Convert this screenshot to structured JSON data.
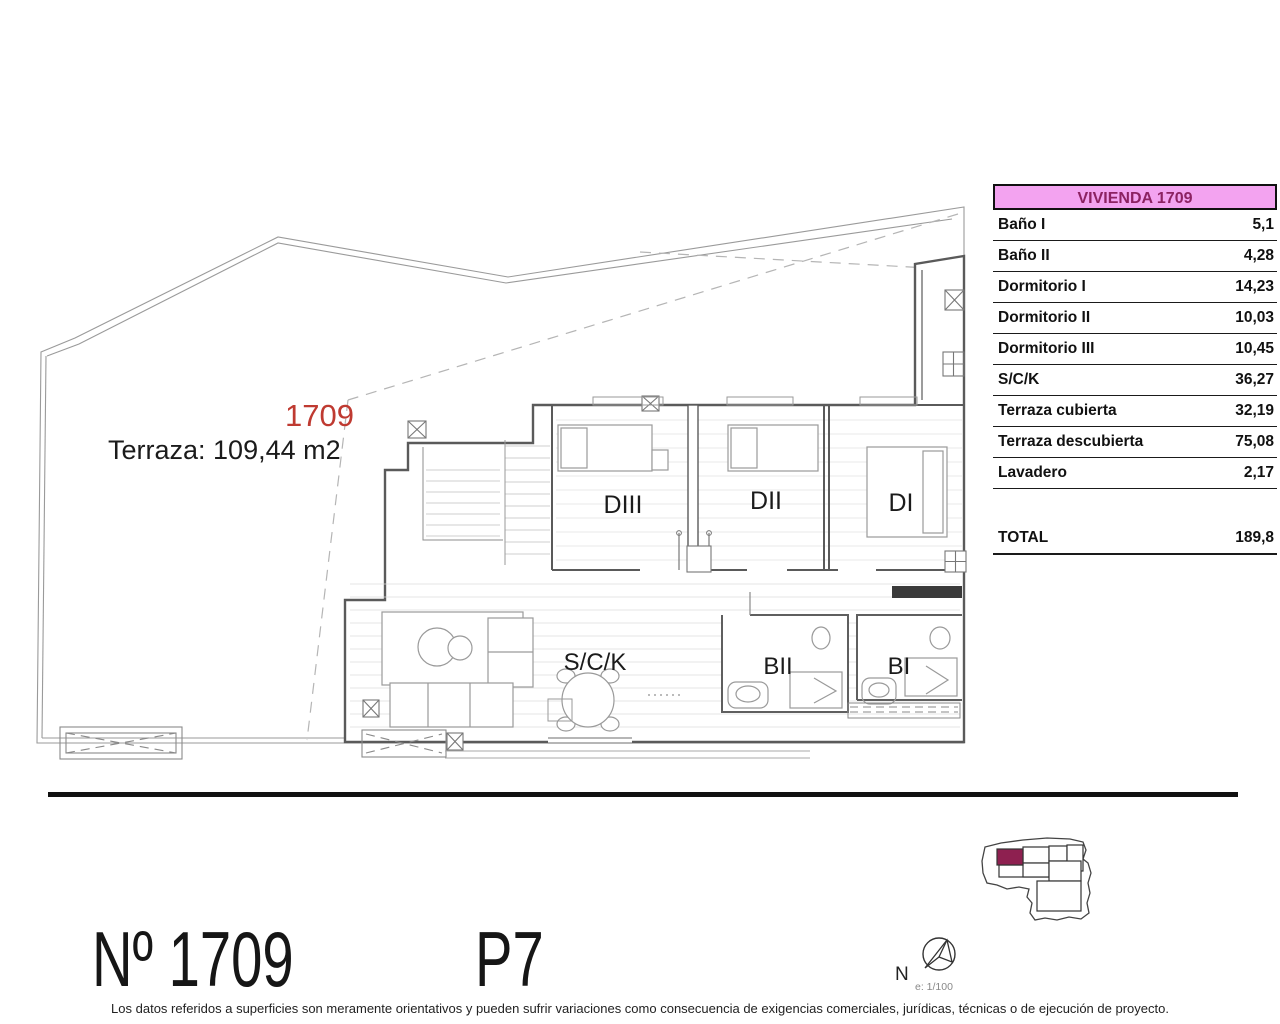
{
  "plan": {
    "unit_label": "1709",
    "terrace_label": "Terraza: 109,44 m2",
    "rooms": {
      "d3": "DIII",
      "d2": "DII",
      "d1": "DI",
      "sck": "S/C/K",
      "b2": "BII",
      "b1": "BI"
    }
  },
  "table": {
    "header": "VIVIENDA 1709",
    "rows": [
      {
        "label": "Baño I",
        "value": "5,1"
      },
      {
        "label": "Baño II",
        "value": "4,28"
      },
      {
        "label": "Dormitorio I",
        "value": "14,23"
      },
      {
        "label": "Dormitorio II",
        "value": "10,03"
      },
      {
        "label": "Dormitorio III",
        "value": "10,45"
      },
      {
        "label": "S/C/K",
        "value": "36,27"
      },
      {
        "label": "Terraza cubierta",
        "value": "32,19"
      },
      {
        "label": "Terraza descubierta",
        "value": "75,08"
      },
      {
        "label": "Lavadero",
        "value": "2,17"
      }
    ],
    "total_label": "TOTAL",
    "total_value": "189,8"
  },
  "footer": {
    "unit_number": "Nº 1709",
    "floor": "P7",
    "north_label": "N",
    "scale": "e: 1/100",
    "disclaimer": "Los datos referidos a superficies son meramente orientativos y pueden sufrir variaciones como consecuencia de exigencias comerciales, jurídicas, técnicas o de ejecución de proyecto."
  },
  "colors": {
    "header_bg": "#f3a3f0",
    "header_text": "#8c2262",
    "unit_label_red": "#bf3a31",
    "keyplan_highlight": "#8e2050",
    "wall": "#5a5a5a",
    "terrace_line": "#9a9a9a"
  }
}
